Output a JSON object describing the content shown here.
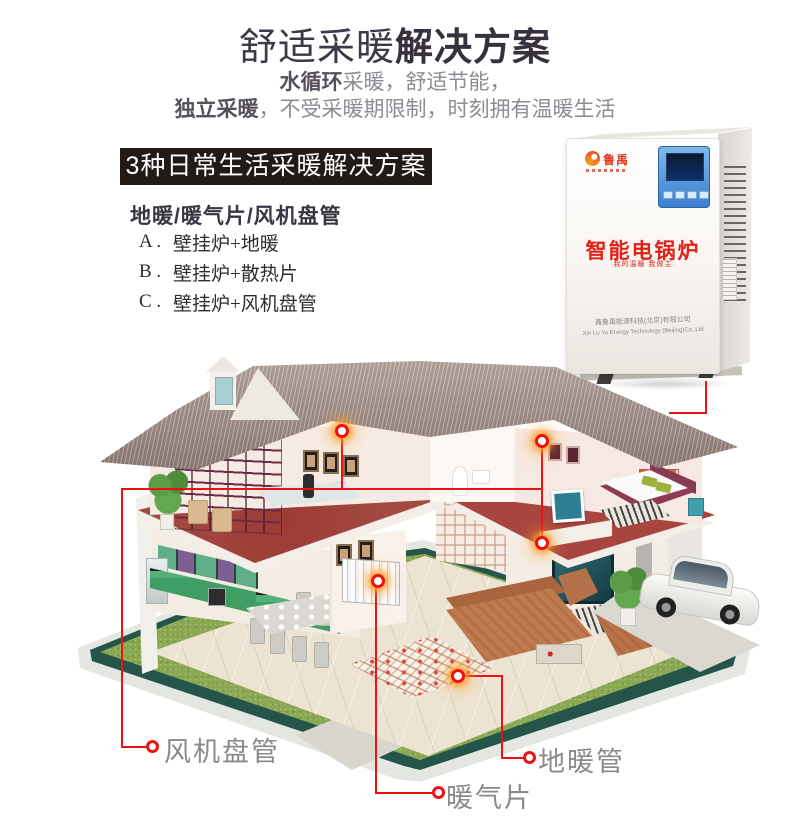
{
  "header": {
    "title": {
      "light": "舒适采暖",
      "bold": "解决方案"
    },
    "subtitle1": {
      "bold": "水循环",
      "rest": "采暖，舒适节能，"
    },
    "subtitle2": {
      "bold": "独立采暖",
      "rest": "，不受采暖期限制，时刻拥有温暖生活"
    }
  },
  "solutions": {
    "banner": "3种日常生活采暖解决方案",
    "heading": "地暖/暖气片/风机盘管",
    "items": [
      {
        "label": "A .",
        "text": "壁挂炉+地暖"
      },
      {
        "label": "B .",
        "text": "壁挂炉+散热片"
      },
      {
        "label": "C .",
        "text": "壁挂炉+风机盘管"
      }
    ]
  },
  "boiler": {
    "brand": "鲁禹",
    "product_name": "智能电锅炉",
    "tagline": "·我的温暖 我做主·",
    "company_cn": "鑫鲁禹能源科技(北京)有限公司",
    "company_en": "Xin Lu Yu Energy Technology (Beijing)Co.,Ltd"
  },
  "callouts": {
    "fan_coil": "风机盘管",
    "radiator": "暖气片",
    "floor_pipe": "地暖管"
  },
  "colors": {
    "accent_red": "#ee1111",
    "banner_bg": "#211b17",
    "product_red": "#e32119",
    "title_dark": "#3e3946",
    "label_gray": "#8a8a8a",
    "roof_brown": "#94817b",
    "lawn_green": "#8aa851",
    "floor_maroon": "#a34a42"
  }
}
